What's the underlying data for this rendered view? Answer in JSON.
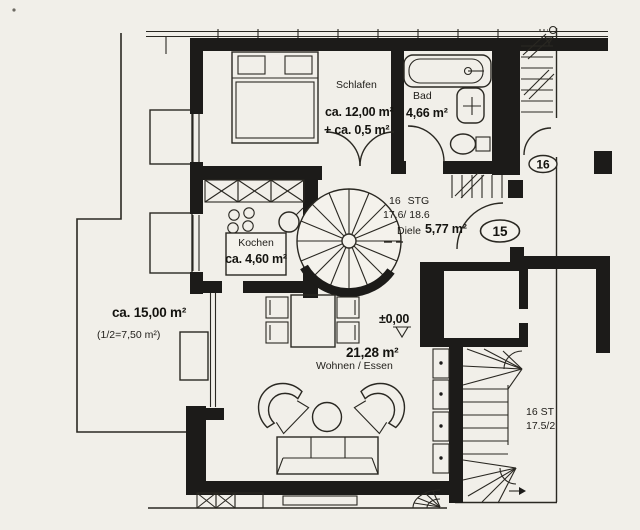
{
  "plan": {
    "rooms": {
      "schlafen": {
        "label": "Schlafen",
        "area": "ca. 12,00 m²",
        "area_extra": "+ ca. 0,5 m²"
      },
      "bad": {
        "label": "Bad",
        "area": "4,66 m²"
      },
      "diele": {
        "label": "Diele",
        "area": "5,77 m²"
      },
      "kochen": {
        "label": "Kochen",
        "area": "ca. 4,60 m²"
      },
      "wohnen_essen": {
        "label": "Wohnen / Essen",
        "area": "21,28 m²"
      },
      "terrasse": {
        "area": "ca. 15,00 m²",
        "area_half": "(1/2=7,50 m²)"
      }
    },
    "stairs": {
      "spiral": {
        "count": "16 STG",
        "dims": "17.6/ 18.6"
      },
      "main": {
        "count": "16 ST",
        "dims": "17.5/2"
      }
    },
    "apartments": {
      "no15": "15",
      "no16": "16"
    },
    "elevation_marker": "±0,00",
    "colors": {
      "paper": "#f1efe9",
      "ink": "#1c1b19"
    }
  }
}
